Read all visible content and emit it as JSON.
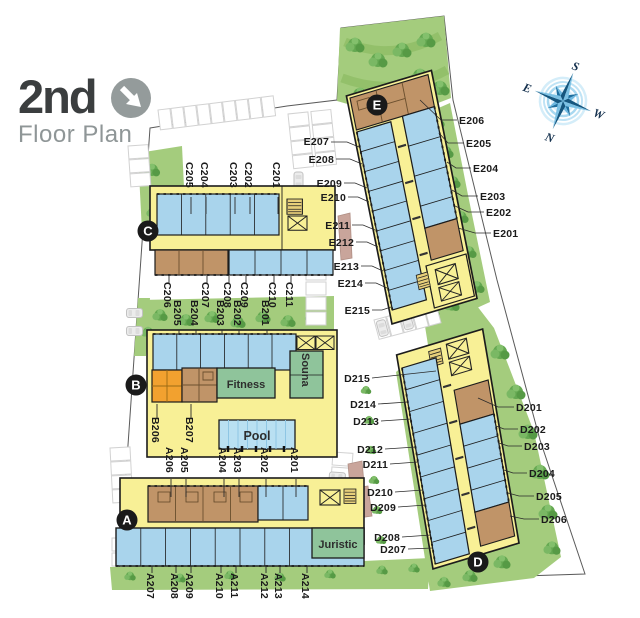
{
  "title": {
    "line1": "2nd",
    "line2": "Floor Plan"
  },
  "compass": {
    "n": "N",
    "s": "S",
    "e": "E",
    "w": "W"
  },
  "badges": {
    "a": "A",
    "b": "B",
    "c": "C",
    "d": "D",
    "e": "E"
  },
  "rooms": {
    "fitness": "Fitness",
    "sauna": "Souna",
    "pool": "Pool",
    "juristic": "Juristic"
  },
  "labels": {
    "c_top": [
      "C205",
      "C204",
      "C203",
      "C202",
      "C201"
    ],
    "c_bottom": [
      "C206",
      "C207",
      "C208",
      "C209",
      "C210",
      "C211"
    ],
    "b_top": [
      "B205",
      "B204",
      "B203",
      "B202",
      "B201"
    ],
    "b_units": [
      "B206",
      "B207"
    ],
    "a_top": [
      "A206",
      "A205",
      "A204",
      "A203",
      "A202",
      "A201"
    ],
    "a_bottom": [
      "A207",
      "A208",
      "A209",
      "A210",
      "A211",
      "A212",
      "A213",
      "A214"
    ],
    "e_left": [
      "E207",
      "E208",
      "E209",
      "E210",
      "E211",
      "E212",
      "E213",
      "E214",
      "E215"
    ],
    "e_right": [
      "E206",
      "E205",
      "E204",
      "E203",
      "E202",
      "E201"
    ],
    "d_left": [
      "D215",
      "D214",
      "D213",
      "D212",
      "D211",
      "D210",
      "D209",
      "D208",
      "D207"
    ],
    "d_right": [
      "D201",
      "D202",
      "D203",
      "D204",
      "D205",
      "D206"
    ]
  },
  "colors": {
    "unit_blue": "#a9d4ec",
    "unit_tan": "#c09468",
    "unit_orange": "#f2a12f",
    "corridor_yellow": "#f8f096",
    "room_green": "#8fc49b",
    "lawn_green": "#a4cc7d",
    "tree_green": "#5ea04c",
    "pool_blue": "#b9e0f2",
    "ramp_beige": "#c9a59b",
    "badge_black": "#1a1a1a",
    "compass_blue": "#2179ae",
    "title_dark": "#3b3e3f",
    "title_gray": "#8f9697"
  }
}
